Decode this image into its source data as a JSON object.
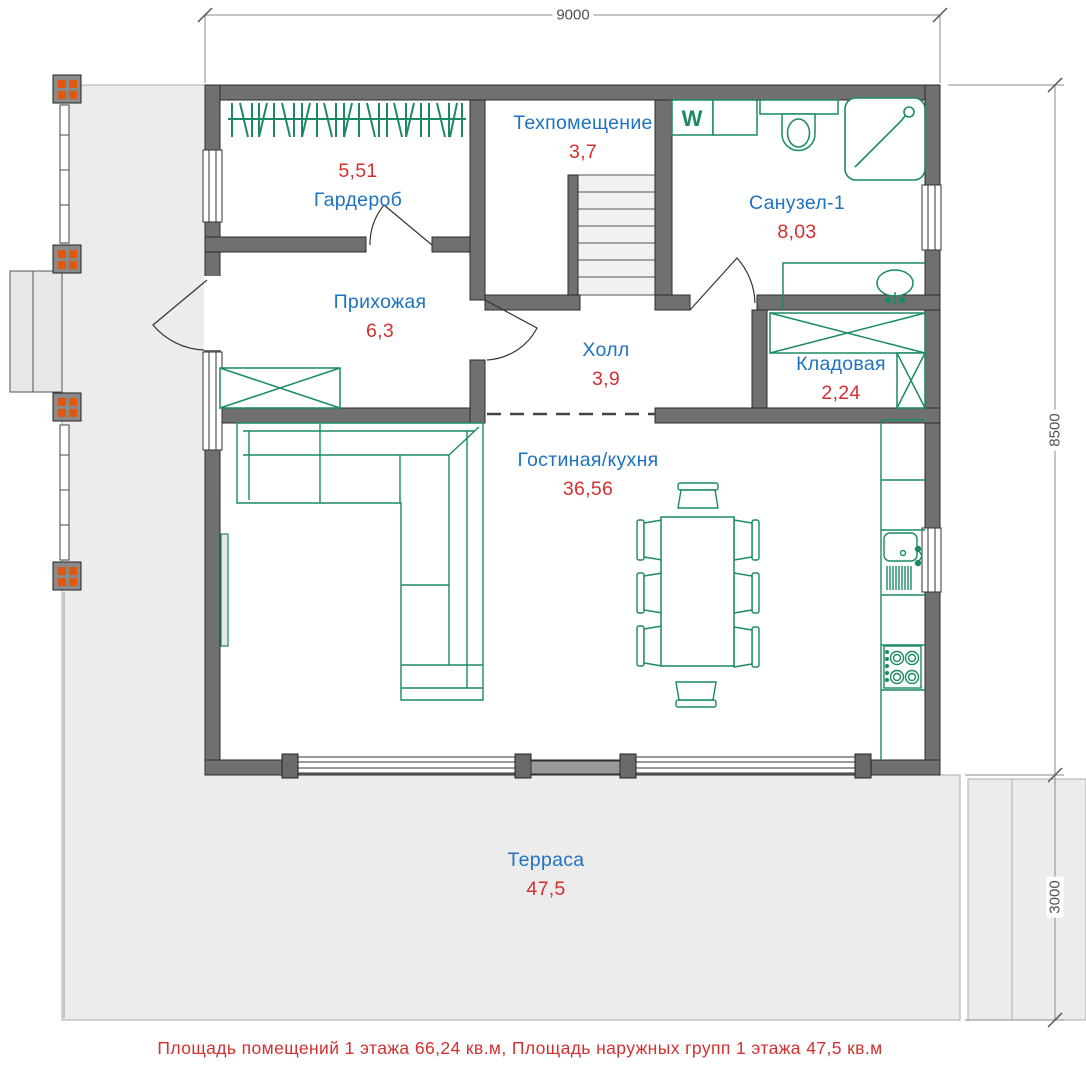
{
  "plan": {
    "dimensions": {
      "width_top": "9000",
      "height_right": "8500",
      "terrace_depth_right": "3000"
    },
    "rooms": [
      {
        "name": "Гардероб",
        "area": "5,51"
      },
      {
        "name": "Техпомещение",
        "area": "3,7"
      },
      {
        "name": "Санузел-1",
        "area": "8,03"
      },
      {
        "name": "Прихожая",
        "area": "6,3"
      },
      {
        "name": "Холл",
        "area": "3,9"
      },
      {
        "name": "Кладовая",
        "area": "2,24"
      },
      {
        "name": "Гостиная/кухня",
        "area": "36,56"
      },
      {
        "name": "Терраса",
        "area": "47,5"
      }
    ],
    "labels": {
      "washing_machine": "W"
    },
    "footer": "Площадь помещений 1 этажа 66,24 кв.м, Площадь наружных групп 1 этажа 47,5 кв.м",
    "colors": {
      "room_name": "#1e72c2",
      "room_area": "#d42f2f",
      "fixtures_green": "#1b8a63",
      "walls_gray": "#707070",
      "terrace_fill": "#ececec",
      "column_accent": "#e0570f",
      "dimension_lines": "#8a8a8a"
    }
  }
}
